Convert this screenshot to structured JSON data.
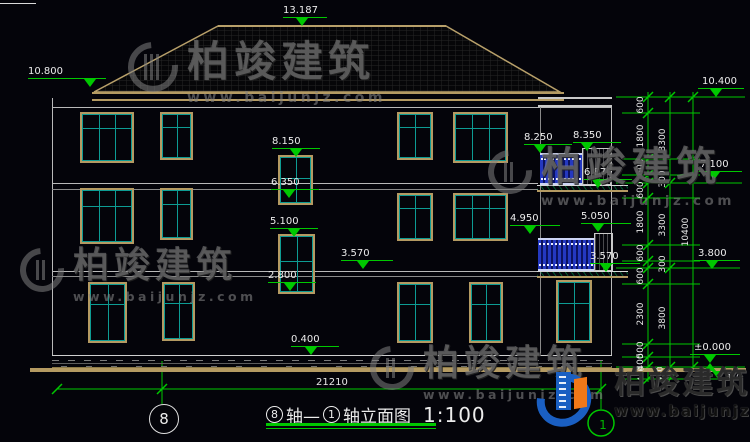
{
  "watermark": {
    "brand": "柏竣建筑",
    "url": "www.baijunjz.com"
  },
  "levels": {
    "ridge": "13.187",
    "eave_left": "10.800",
    "stair_top": "8.150",
    "stair_upper_sill": "6.350",
    "stair_mid": "5.100",
    "stair_low_sill": "2.800",
    "floor2_band": "3.570",
    "balc3_left": "8.250",
    "balc3_right": "8.350",
    "balc3_floor": "6.870",
    "balc2_left": "4.950",
    "balc2_right": "5.050",
    "balc2_floor": "3.570",
    "right_top": "10.400",
    "right_mid": "7.100",
    "right_low": "3.800",
    "right_zero": "±0.000",
    "plinth_top": "0.400"
  },
  "dims": {
    "overall_width": "21210",
    "col1": [
      "600",
      "1800",
      "600",
      "600",
      "1800",
      "600",
      "600",
      "2300",
      "500",
      "400",
      "450"
    ],
    "col2": [
      "3300",
      "300",
      "3300",
      "300",
      "3800",
      "450"
    ],
    "col3": [
      "10400"
    ],
    "right_base": "450"
  },
  "title": {
    "axis_a": "8",
    "seg1": "轴—",
    "axis_b": "1",
    "seg2": "轴立面图",
    "scale": "1:100"
  },
  "axis_bubbles": {
    "left": "8",
    "right": "1"
  }
}
